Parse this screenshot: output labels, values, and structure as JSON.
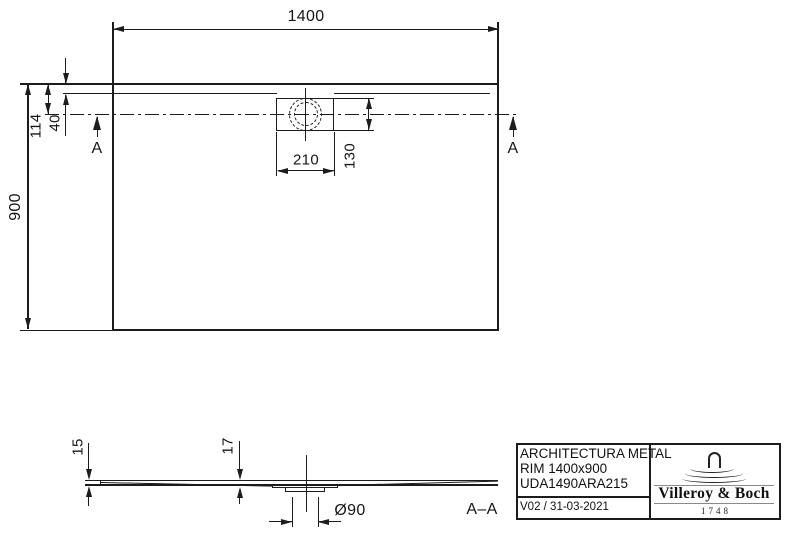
{
  "top_view": {
    "width_label": "1400",
    "height_label": "900",
    "drain_center_offset_label": "114",
    "rim_width_label": "40",
    "drain_cutout_width_label": "210",
    "drain_cutout_height_label": "130",
    "section_marker_left": "A",
    "section_marker_right": "A"
  },
  "section_view": {
    "edge_thickness_label": "15",
    "drain_area_thickness_label": "17",
    "drain_diameter_label": "Ø90",
    "title": "A–A"
  },
  "title_block": {
    "product_series": "ARCHITECTURA METAL",
    "product_model": "RIM 1400x900",
    "product_code": "UDA1490ARA215",
    "revision_date": "V02 / 31-03-2021",
    "brand_name": "Villeroy & Boch",
    "brand_founded": "1748"
  },
  "colors": {
    "line": "#1c1c1c",
    "background": "#ffffff"
  }
}
